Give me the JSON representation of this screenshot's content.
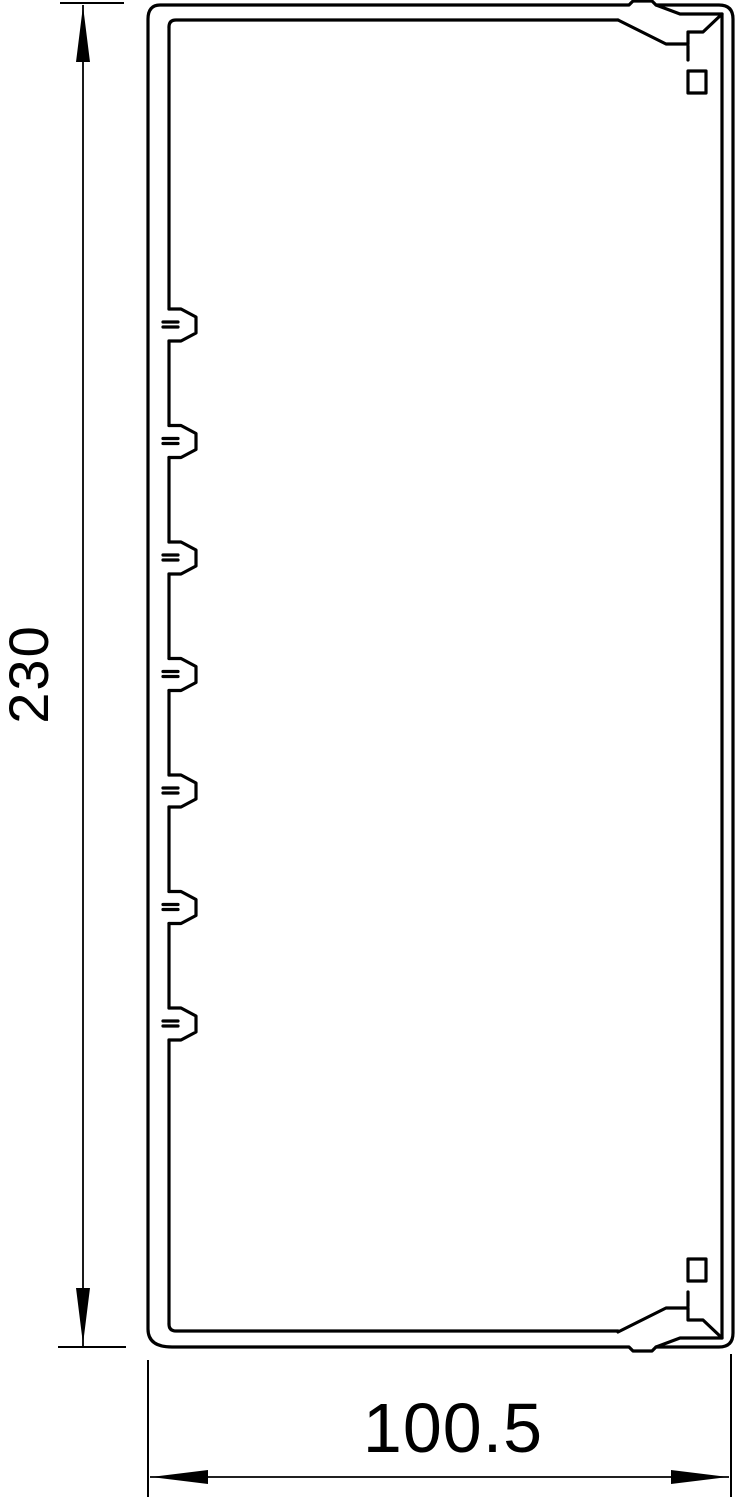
{
  "drawing": {
    "line_color": "#000000",
    "background_color": "#ffffff",
    "profile": {
      "clip_count": 7
    }
  },
  "dimensions": {
    "height": {
      "value": "230"
    },
    "width": {
      "value": "100.5"
    }
  }
}
